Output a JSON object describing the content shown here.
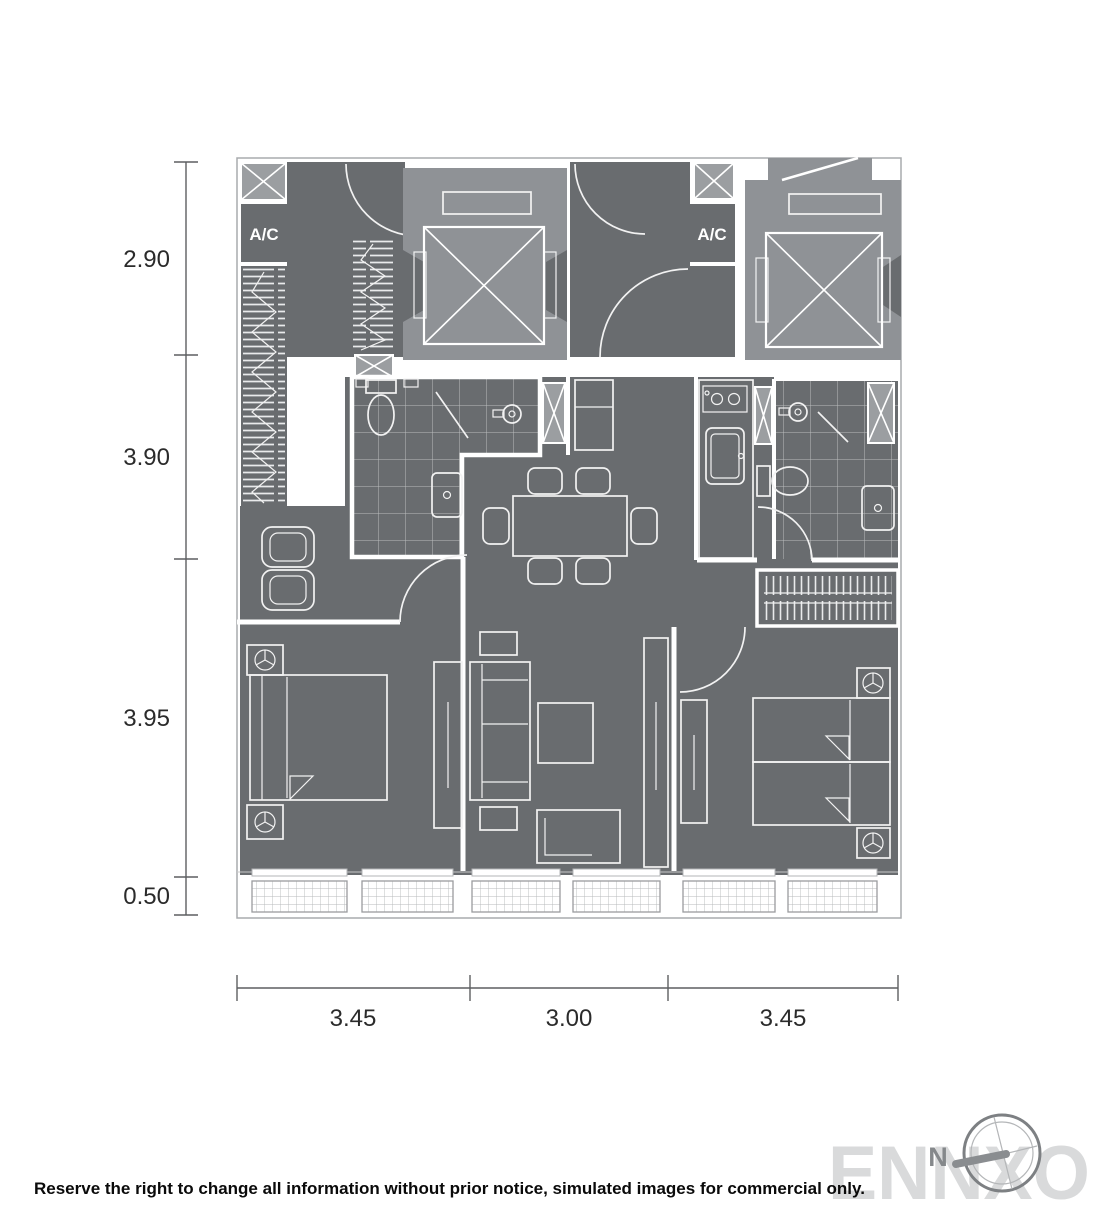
{
  "plan": {
    "ac_label": "A/C",
    "dimensions": {
      "left": [
        "2.90",
        "3.90",
        "3.95",
        "0.50"
      ],
      "bottom": [
        "3.45",
        "3.00",
        "3.45"
      ]
    }
  },
  "footer": {
    "disclaimer": "Reserve the right to change all information without prior notice, simulated images for commercial only.",
    "watermark": "ENNXO",
    "compass_north": "N"
  },
  "icons": {
    "compass-icon": "double circle with tilted cross and thick needle",
    "elevator-icon": "square cab with X cross",
    "shaft-icon": "small gray rect with X cross",
    "ceiling-fan-icon": "circle with three spokes",
    "toilet-icon": "tank rectangle with oval bowl",
    "shower-head-icon": "circle with arm",
    "basin-icon": "rounded rectangle with drain dot",
    "stove-icon": "rectangle with two burner circles",
    "door-arc-icon": "quarter-circle swing arc",
    "hanger-rail-icon": "rail with tick marks",
    "balcony-railing-icon": "fine grid panel"
  },
  "colors": {
    "floor": "#696c6f",
    "elevator_core": "#8f9296",
    "hatch_box": "#9b9ea1",
    "walls": "#ffffff",
    "plan_outline": "#a9abad",
    "dimension_text": "#2b2b2b",
    "ac_text": "#ffffff",
    "watermark": "#d9dadb",
    "compass": "#85888b",
    "disclaimer_text": "#0a0a0a"
  }
}
